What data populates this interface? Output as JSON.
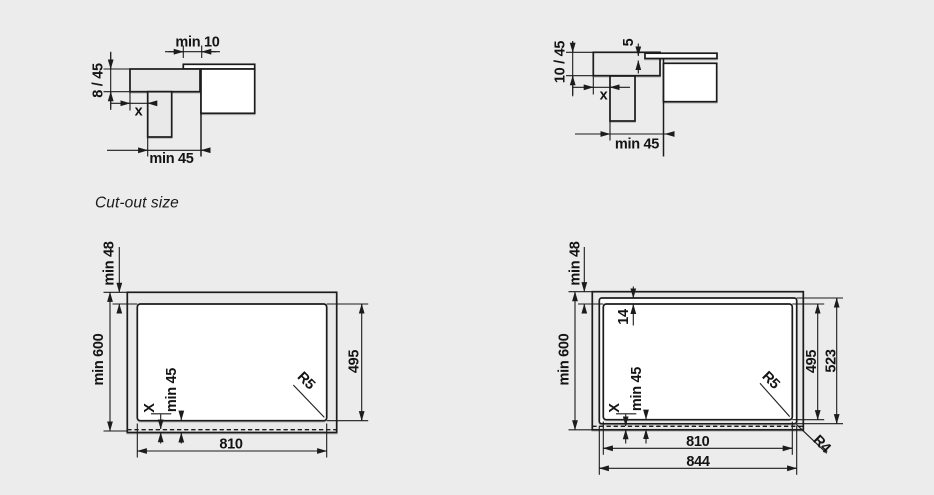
{
  "colors": {
    "background": "#ECECEC",
    "line": "#1C1C1C",
    "fill_light_gray": "#E9E9E9",
    "fill_white": "#FFFFFF"
  },
  "caption": "Cut-out size",
  "top_left": {
    "min_overlap": "min 10",
    "worktop_thickness": "8 / 45",
    "x": "x",
    "min_clearance": "min 45"
  },
  "top_right": {
    "glass_gap": "5",
    "worktop_thickness": "10 / 45",
    "x": "x",
    "min_clearance": "min 45"
  },
  "bottom_left": {
    "min_back": "min 48",
    "min_depth": "min 600",
    "cutout_height": "495",
    "cutout_width": "810",
    "x": "X",
    "min_front": "min 45",
    "corner_radius": "R5"
  },
  "bottom_right": {
    "min_back": "min 48",
    "min_depth": "min 600",
    "rebate_width": "14",
    "cutout_height": "495",
    "recess_height": "523",
    "cutout_width": "810",
    "recess_width": "844",
    "x": "X",
    "min_front": "min 45",
    "corner_radius_inner": "R5",
    "corner_radius_outer": "R4"
  }
}
